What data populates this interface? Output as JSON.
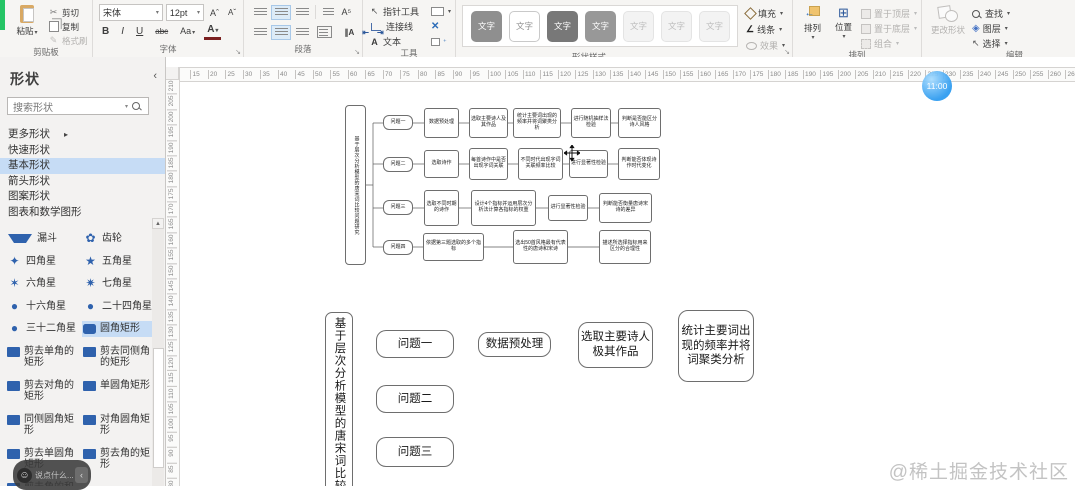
{
  "ribbon": {
    "clipboard": {
      "label": "剪贴板",
      "paste": "粘贴",
      "cut": "剪切",
      "copy": "复制",
      "format_painter": "格式刷"
    },
    "font": {
      "label": "字体",
      "font_name": "宋体",
      "font_size": "12pt",
      "bold": "B",
      "italic": "I",
      "underline": "U",
      "strike": "abc",
      "case": "Aa",
      "color": "A",
      "grow": "Aˆ",
      "shrink": "Aˇ"
    },
    "paragraph": {
      "label": "段落",
      "text_direction": "∥A"
    },
    "tools": {
      "label": "工具",
      "pointer": "指针工具",
      "connector": "连接线",
      "text_prefix": "A",
      "text": "文本",
      "x_tool": "✕"
    },
    "shape_styles": {
      "label": "形状样式",
      "swatch_label": "文字",
      "swatches": [
        {
          "fill": "#8f8f8f",
          "text": "#ffffff",
          "border": "#8f8f8f"
        },
        {
          "fill": "#ffffff",
          "text": "#909090",
          "border": "#c9c9c9"
        },
        {
          "fill": "#787878",
          "text": "#ffffff",
          "border": "#787878"
        },
        {
          "fill": "#989898",
          "text": "#ffffff",
          "border": "#989898"
        },
        {
          "fill": "#f3f3f3",
          "text": "#bdbdbd",
          "border": "#e4e4e4"
        },
        {
          "fill": "#f3f3f3",
          "text": "#bdbdbd",
          "border": "#e4e4e4"
        },
        {
          "fill": "#f3f3f3",
          "text": "#bdbdbd",
          "border": "#e4e4e4"
        }
      ],
      "fill": "填充",
      "line": "线条",
      "effects": "效果"
    },
    "arrange": {
      "label": "排列",
      "align": "排列",
      "position": "位置",
      "bring_front": "置于顶层",
      "send_back": "置于底层",
      "group": "组合"
    },
    "editing": {
      "label": "编辑",
      "change_shape": "更改形状",
      "find": "查找",
      "layers": "图层",
      "select": "选择"
    }
  },
  "sidebar": {
    "title": "形状",
    "collapse": "‹",
    "search_placeholder": "搜索形状",
    "nav": [
      {
        "label": "更多形状",
        "arrow": "▸"
      },
      {
        "label": "快速形状"
      },
      {
        "label": "基本形状",
        "selected": true
      },
      {
        "label": "箭头形状"
      },
      {
        "label": "图案形状"
      },
      {
        "label": "图表和数学图形"
      }
    ],
    "gallery": [
      {
        "label": "漏斗",
        "icon": "funnel"
      },
      {
        "label": "齿轮",
        "icon": "gear"
      },
      {
        "label": "四角星",
        "icon": "star4"
      },
      {
        "label": "五角星",
        "icon": "star5"
      },
      {
        "label": "六角星",
        "icon": "star6"
      },
      {
        "label": "七角星",
        "icon": "star7"
      },
      {
        "label": "十六角星",
        "icon": "circle"
      },
      {
        "label": "二十四角星",
        "icon": "circle"
      },
      {
        "label": "三十二角星",
        "icon": "circle"
      },
      {
        "label": "圆角矩形",
        "icon": "rounded-rect",
        "selected": true
      },
      {
        "label": "剪去单角的矩形",
        "icon": "rect"
      },
      {
        "label": "剪去同侧角的矩形",
        "icon": "rect"
      },
      {
        "label": "剪去对角的矩形",
        "icon": "rect"
      },
      {
        "label": "单圆角矩形",
        "icon": "rect"
      },
      {
        "label": "同侧圆角矩形",
        "icon": "rect"
      },
      {
        "label": "对角圆角矩形",
        "icon": "rect"
      },
      {
        "label": "剪去单圆角矩形",
        "icon": "rect"
      },
      {
        "label": "剪去角的矩形",
        "icon": "rect"
      },
      {
        "label": "剪去角的和圆角矩形",
        "icon": "rect"
      }
    ]
  },
  "canvas": {
    "h_ruler": {
      "start": 15,
      "end": 265,
      "step": 5,
      "origin_px": 24,
      "step_px": 17.5
    },
    "v_ruler": {
      "start": 210,
      "end": 80,
      "step": -5,
      "origin_px": 21,
      "step_px": 15.38
    },
    "clock_bubble": "11:00"
  },
  "diagram_top": {
    "nodes": [
      {
        "x": 179,
        "y": 48,
        "w": 21,
        "h": 160,
        "t": "基于层次分析模型的唐宋词比较问题研究",
        "v": 1
      },
      {
        "x": 217,
        "y": 58,
        "w": 30,
        "h": 15,
        "t": "问题一",
        "q": 1
      },
      {
        "x": 258,
        "y": 51,
        "w": 35,
        "h": 30,
        "t": "数据预处理"
      },
      {
        "x": 303,
        "y": 51,
        "w": 39,
        "h": 30,
        "t": "选取主要诗人及其作品"
      },
      {
        "x": 347,
        "y": 51,
        "w": 48,
        "h": 30,
        "t": "统计主要词出现的频率并将词聚类分析"
      },
      {
        "x": 405,
        "y": 51,
        "w": 40,
        "h": 30,
        "t": "进行随机抽样法检验"
      },
      {
        "x": 452,
        "y": 51,
        "w": 43,
        "h": 30,
        "t": "判断是否能区分诗人风格"
      },
      {
        "x": 217,
        "y": 100,
        "w": 30,
        "h": 15,
        "t": "问题二",
        "q": 1
      },
      {
        "x": 258,
        "y": 93,
        "w": 35,
        "h": 28,
        "t": "选取诗作"
      },
      {
        "x": 303,
        "y": 91,
        "w": 39,
        "h": 32,
        "t": "每首诗作中是否出现字词关联"
      },
      {
        "x": 352,
        "y": 91,
        "w": 45,
        "h": 32,
        "t": "不同时代出现字词关联频率比较"
      },
      {
        "x": 403,
        "y": 93,
        "w": 39,
        "h": 28,
        "t": "进行显著性检验"
      },
      {
        "x": 452,
        "y": 91,
        "w": 42,
        "h": 32,
        "t": "判断能否体现诗作时代变化"
      },
      {
        "x": 217,
        "y": 143,
        "w": 30,
        "h": 15,
        "t": "问题三",
        "q": 1
      },
      {
        "x": 258,
        "y": 133,
        "w": 35,
        "h": 36,
        "t": "选取不同时期的诗作"
      },
      {
        "x": 305,
        "y": 133,
        "w": 65,
        "h": 36,
        "t": "设计4个指标并运用层次分析法计算各指标的权重"
      },
      {
        "x": 382,
        "y": 138,
        "w": 40,
        "h": 26,
        "t": "进行显著性检验"
      },
      {
        "x": 433,
        "y": 136,
        "w": 53,
        "h": 30,
        "t": "判断能否衡量唐诗宋诗的差异"
      },
      {
        "x": 217,
        "y": 183,
        "w": 30,
        "h": 15,
        "t": "问题四",
        "q": 1
      },
      {
        "x": 257,
        "y": 176,
        "w": 61,
        "h": 28,
        "t": "依据第三题选取的多个指标"
      },
      {
        "x": 347,
        "y": 173,
        "w": 55,
        "h": 34,
        "t": "选出50首风格最有代表性的唐诗和宋诗"
      },
      {
        "x": 433,
        "y": 173,
        "w": 52,
        "h": 34,
        "t": "描述所选择指标用来区分的合理性"
      }
    ],
    "edges": [
      [
        200,
        128,
        207,
        128
      ],
      [
        207,
        66,
        207,
        190
      ],
      [
        207,
        66,
        217,
        66
      ],
      [
        207,
        107,
        217,
        107
      ],
      [
        207,
        151,
        217,
        151
      ],
      [
        207,
        190,
        217,
        190
      ],
      [
        247,
        66,
        258,
        66
      ],
      [
        293,
        66,
        303,
        66
      ],
      [
        342,
        66,
        347,
        66
      ],
      [
        395,
        66,
        405,
        66
      ],
      [
        445,
        66,
        452,
        66
      ],
      [
        247,
        107,
        258,
        107
      ],
      [
        293,
        107,
        303,
        107
      ],
      [
        342,
        107,
        352,
        107
      ],
      [
        397,
        107,
        403,
        107
      ],
      [
        442,
        107,
        452,
        107
      ],
      [
        247,
        151,
        258,
        151
      ],
      [
        293,
        151,
        305,
        151
      ],
      [
        370,
        151,
        382,
        151
      ],
      [
        422,
        151,
        433,
        151
      ],
      [
        247,
        190,
        257,
        190
      ],
      [
        318,
        190,
        347,
        190
      ],
      [
        402,
        190,
        433,
        190
      ]
    ]
  },
  "diagram_bottom": {
    "nodes": [
      {
        "x": 159,
        "y": 255,
        "w": 28,
        "h": 185,
        "t": "基于层次分析模型的唐宋词比较",
        "v": 1
      },
      {
        "x": 210,
        "y": 273,
        "w": 78,
        "h": 28,
        "t": "问题一"
      },
      {
        "x": 312,
        "y": 275,
        "w": 73,
        "h": 25,
        "t": "数据预处理"
      },
      {
        "x": 412,
        "y": 265,
        "w": 75,
        "h": 46,
        "t": "选取主要诗人极其作品"
      },
      {
        "x": 512,
        "y": 253,
        "w": 76,
        "h": 72,
        "t": "统计主要词出现的频率并将词聚类分析"
      },
      {
        "x": 210,
        "y": 328,
        "w": 78,
        "h": 28,
        "t": "问题二"
      },
      {
        "x": 210,
        "y": 380,
        "w": 78,
        "h": 30,
        "t": "问题三"
      }
    ],
    "edges": []
  },
  "overlays": {
    "chat_icon": "☺",
    "chat_placeholder": "说点什么...",
    "chat_collapse": "‹",
    "watermark": "@稀土掘金技术社区"
  },
  "colors": {
    "accent_green": "#25c465",
    "selection_blue": "#c6dcf5",
    "shape_icon_blue": "#2f62ad",
    "clock_blue": "#2b9af0"
  }
}
